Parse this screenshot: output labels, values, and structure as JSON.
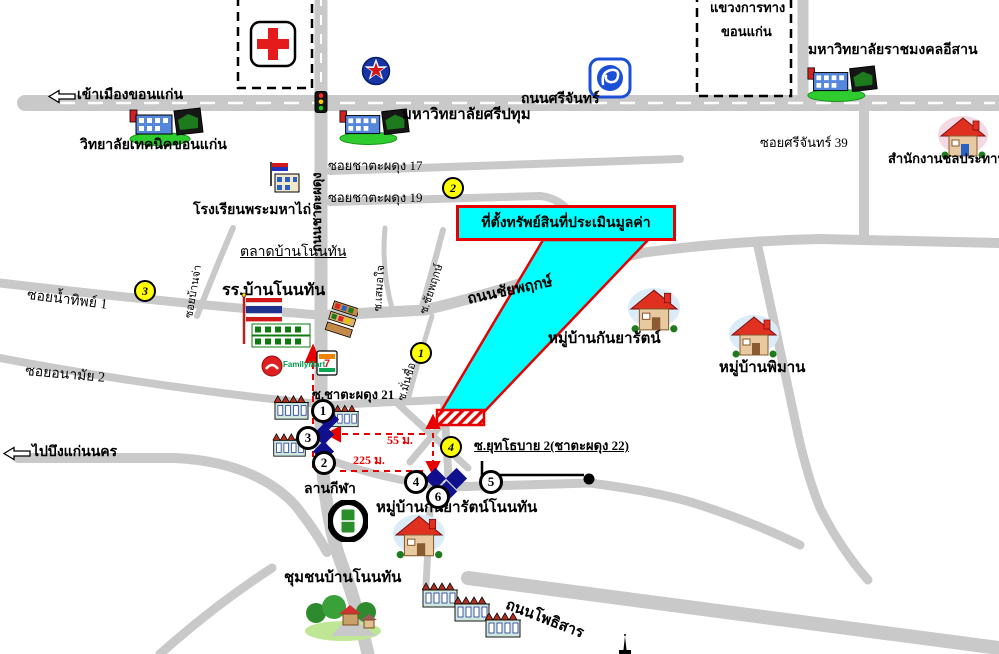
{
  "labels": {
    "enter_city": "เข้าเมืองขอนแก่น",
    "to_bueng": "ไปบึงแก่นนคร",
    "srichan_road": "ถนนศรีจันทร์",
    "kwang_line1": "แขวงการทาง",
    "kwang_line2": "ขอนแก่น",
    "rmuti": "มหาวิทยาลัยราชมงคลอีสาน",
    "sripatum": "มหาวิทยาลัยศรีปทุม",
    "technic_college": "วิทยาลัยเทคนิคขอนแก่น",
    "irrigation_office": "สำนักงานชลประทาน",
    "soi_srichan_39": "ซอยศรีจันทร์ 39",
    "soi_17": "ซอยชาตะผดุง 17",
    "soi_19": "ซอยชาตะผดุง 19",
    "mahathai_school": "โรงเรียนพระมหาไถ่",
    "market": "ตลาดบ้านโนนทัน",
    "nonthan_school": "รร.บ้านโนนทัน",
    "soi_namthip": "ซอยน้ำทิพย์ 1",
    "soi_anamai": "ซอยอนามัย 2",
    "property_box": "ที่ตั้งทรัพย์สินที่ประเมินมูลค่า",
    "chaiyapruek_road": "ถนนชัยพฤกษ์",
    "kanyarat_village": "หมู่บ้านกันยารัตน์",
    "phiman_village": "หมู่บ้านพิมาน",
    "chatapadung_road": "ถนนชาตะผดุง",
    "soi_samoejai": "ซ.เสมอใจ",
    "soi_chaiyapruek": "ซ.ชัยพฤกษ์",
    "soi_manchue": "ซ.มั่นชื่อ",
    "soi_banja": "ซอยบ้านจ่า",
    "soi_21": "ซ.ชาตะผดุง 21",
    "soi_22": "ซ.ยุทโธบาย 2(ชาตะผดุง 22)",
    "sports_ground": "ลานกีฬา",
    "kanyarat_nonthan": "หมู่บ้านกันยารัตน์โนนทัน",
    "community": "ชุมชนบ้านโนนทัน",
    "phothisan_road": "ถนนโพธิสาร",
    "d55": "55 ม.",
    "d225": "225 ม."
  },
  "markers": {
    "yellow": [
      "1",
      "2",
      "3",
      "4"
    ],
    "white": [
      "1",
      "2",
      "3",
      "4",
      "5",
      "6"
    ]
  },
  "icons": {
    "seven": "7",
    "familymart": "FamilyMart"
  },
  "colors": {
    "road": "#c9c9c9",
    "highlight_cyan": "#00ffff",
    "accent_red": "#e60000",
    "marker_yellow": "#ffff00",
    "diamond_blue": "#10108e"
  }
}
